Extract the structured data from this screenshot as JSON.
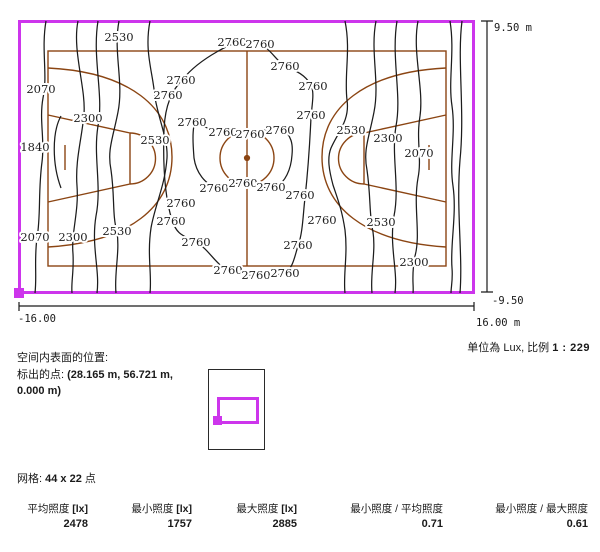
{
  "plot": {
    "dim_top_right": "9.50 m",
    "dim_bottom_right": "-9.50",
    "dim_bottom_left": "-16.00",
    "dim_bottom_right_x": "16.00 m",
    "unit_prefix": "单位為 Lux, 比例",
    "unit_scale_value": "1 : 229",
    "boundary_color": "#cd35ec",
    "court_color": "#8b4513",
    "contour_color": "#1c1c1c"
  },
  "surface_info": {
    "line1": "空间内表面的位置:",
    "line2_prefix": "标出的点: ",
    "line2_value": "(28.165 m, 56.721 m,",
    "line3_value": "0.000 m)"
  },
  "grid": {
    "prefix": "网格: ",
    "value": "44 x 22",
    "suffix": " 点"
  },
  "stats": [
    {
      "label": "平均照度",
      "unit": "[lx]",
      "value": "2478"
    },
    {
      "label": "最小照度",
      "unit": "[lx]",
      "value": "1757"
    },
    {
      "label": "最大照度",
      "unit": "[lx]",
      "value": "2885"
    },
    {
      "label": "最小照度 / 平均照度",
      "unit": "",
      "value": "0.71"
    },
    {
      "label": "最小照度 / 最大照度",
      "unit": "",
      "value": "0.61"
    }
  ],
  "chart_data": {
    "type": "heatmap",
    "subtype": "isolux_contour_plot",
    "unit": "Lux",
    "scale": "1 : 229",
    "x_range_m": [
      -16.0,
      16.0
    ],
    "y_range_m": [
      -9.5,
      9.5
    ],
    "grid_points": "44 x 22",
    "contour_levels_lx": [
      1840,
      2070,
      2300,
      2530,
      2760
    ],
    "statistics": {
      "avg_lx": 2478,
      "min_lx": 1757,
      "max_lx": 2885,
      "min_over_avg": 0.71,
      "min_over_max": 0.61
    },
    "contour_labels": [
      {
        "v": "2530",
        "x": 119,
        "y": 37
      },
      {
        "v": "2070",
        "x": 41,
        "y": 89
      },
      {
        "v": "2300",
        "x": 88,
        "y": 118
      },
      {
        "v": "1840",
        "x": 35,
        "y": 147
      },
      {
        "v": "2530",
        "x": 155,
        "y": 140
      },
      {
        "v": "2070",
        "x": 35,
        "y": 237
      },
      {
        "v": "2300",
        "x": 73,
        "y": 237
      },
      {
        "v": "2530",
        "x": 117,
        "y": 231
      },
      {
        "v": "2760",
        "x": 232,
        "y": 42
      },
      {
        "v": "2760",
        "x": 260,
        "y": 44
      },
      {
        "v": "2760",
        "x": 285,
        "y": 66
      },
      {
        "v": "2760",
        "x": 181,
        "y": 80
      },
      {
        "v": "2760",
        "x": 168,
        "y": 95
      },
      {
        "v": "2760",
        "x": 313,
        "y": 86
      },
      {
        "v": "2760",
        "x": 311,
        "y": 115
      },
      {
        "v": "2760",
        "x": 192,
        "y": 122
      },
      {
        "v": "2760",
        "x": 223,
        "y": 132
      },
      {
        "v": "2760",
        "x": 250,
        "y": 134
      },
      {
        "v": "2760",
        "x": 280,
        "y": 130
      },
      {
        "v": "2760",
        "x": 214,
        "y": 188
      },
      {
        "v": "2760",
        "x": 243,
        "y": 183
      },
      {
        "v": "2760",
        "x": 271,
        "y": 187
      },
      {
        "v": "2760",
        "x": 300,
        "y": 195
      },
      {
        "v": "2760",
        "x": 181,
        "y": 203
      },
      {
        "v": "2760",
        "x": 171,
        "y": 221
      },
      {
        "v": "2760",
        "x": 196,
        "y": 242
      },
      {
        "v": "2760",
        "x": 322,
        "y": 220
      },
      {
        "v": "2760",
        "x": 298,
        "y": 245
      },
      {
        "v": "2760",
        "x": 228,
        "y": 270
      },
      {
        "v": "2760",
        "x": 256,
        "y": 275
      },
      {
        "v": "2760",
        "x": 285,
        "y": 273
      },
      {
        "v": "2530",
        "x": 351,
        "y": 130
      },
      {
        "v": "2300",
        "x": 388,
        "y": 138
      },
      {
        "v": "2070",
        "x": 419,
        "y": 153
      },
      {
        "v": "2530",
        "x": 381,
        "y": 222
      },
      {
        "v": "2300",
        "x": 414,
        "y": 262
      }
    ]
  }
}
